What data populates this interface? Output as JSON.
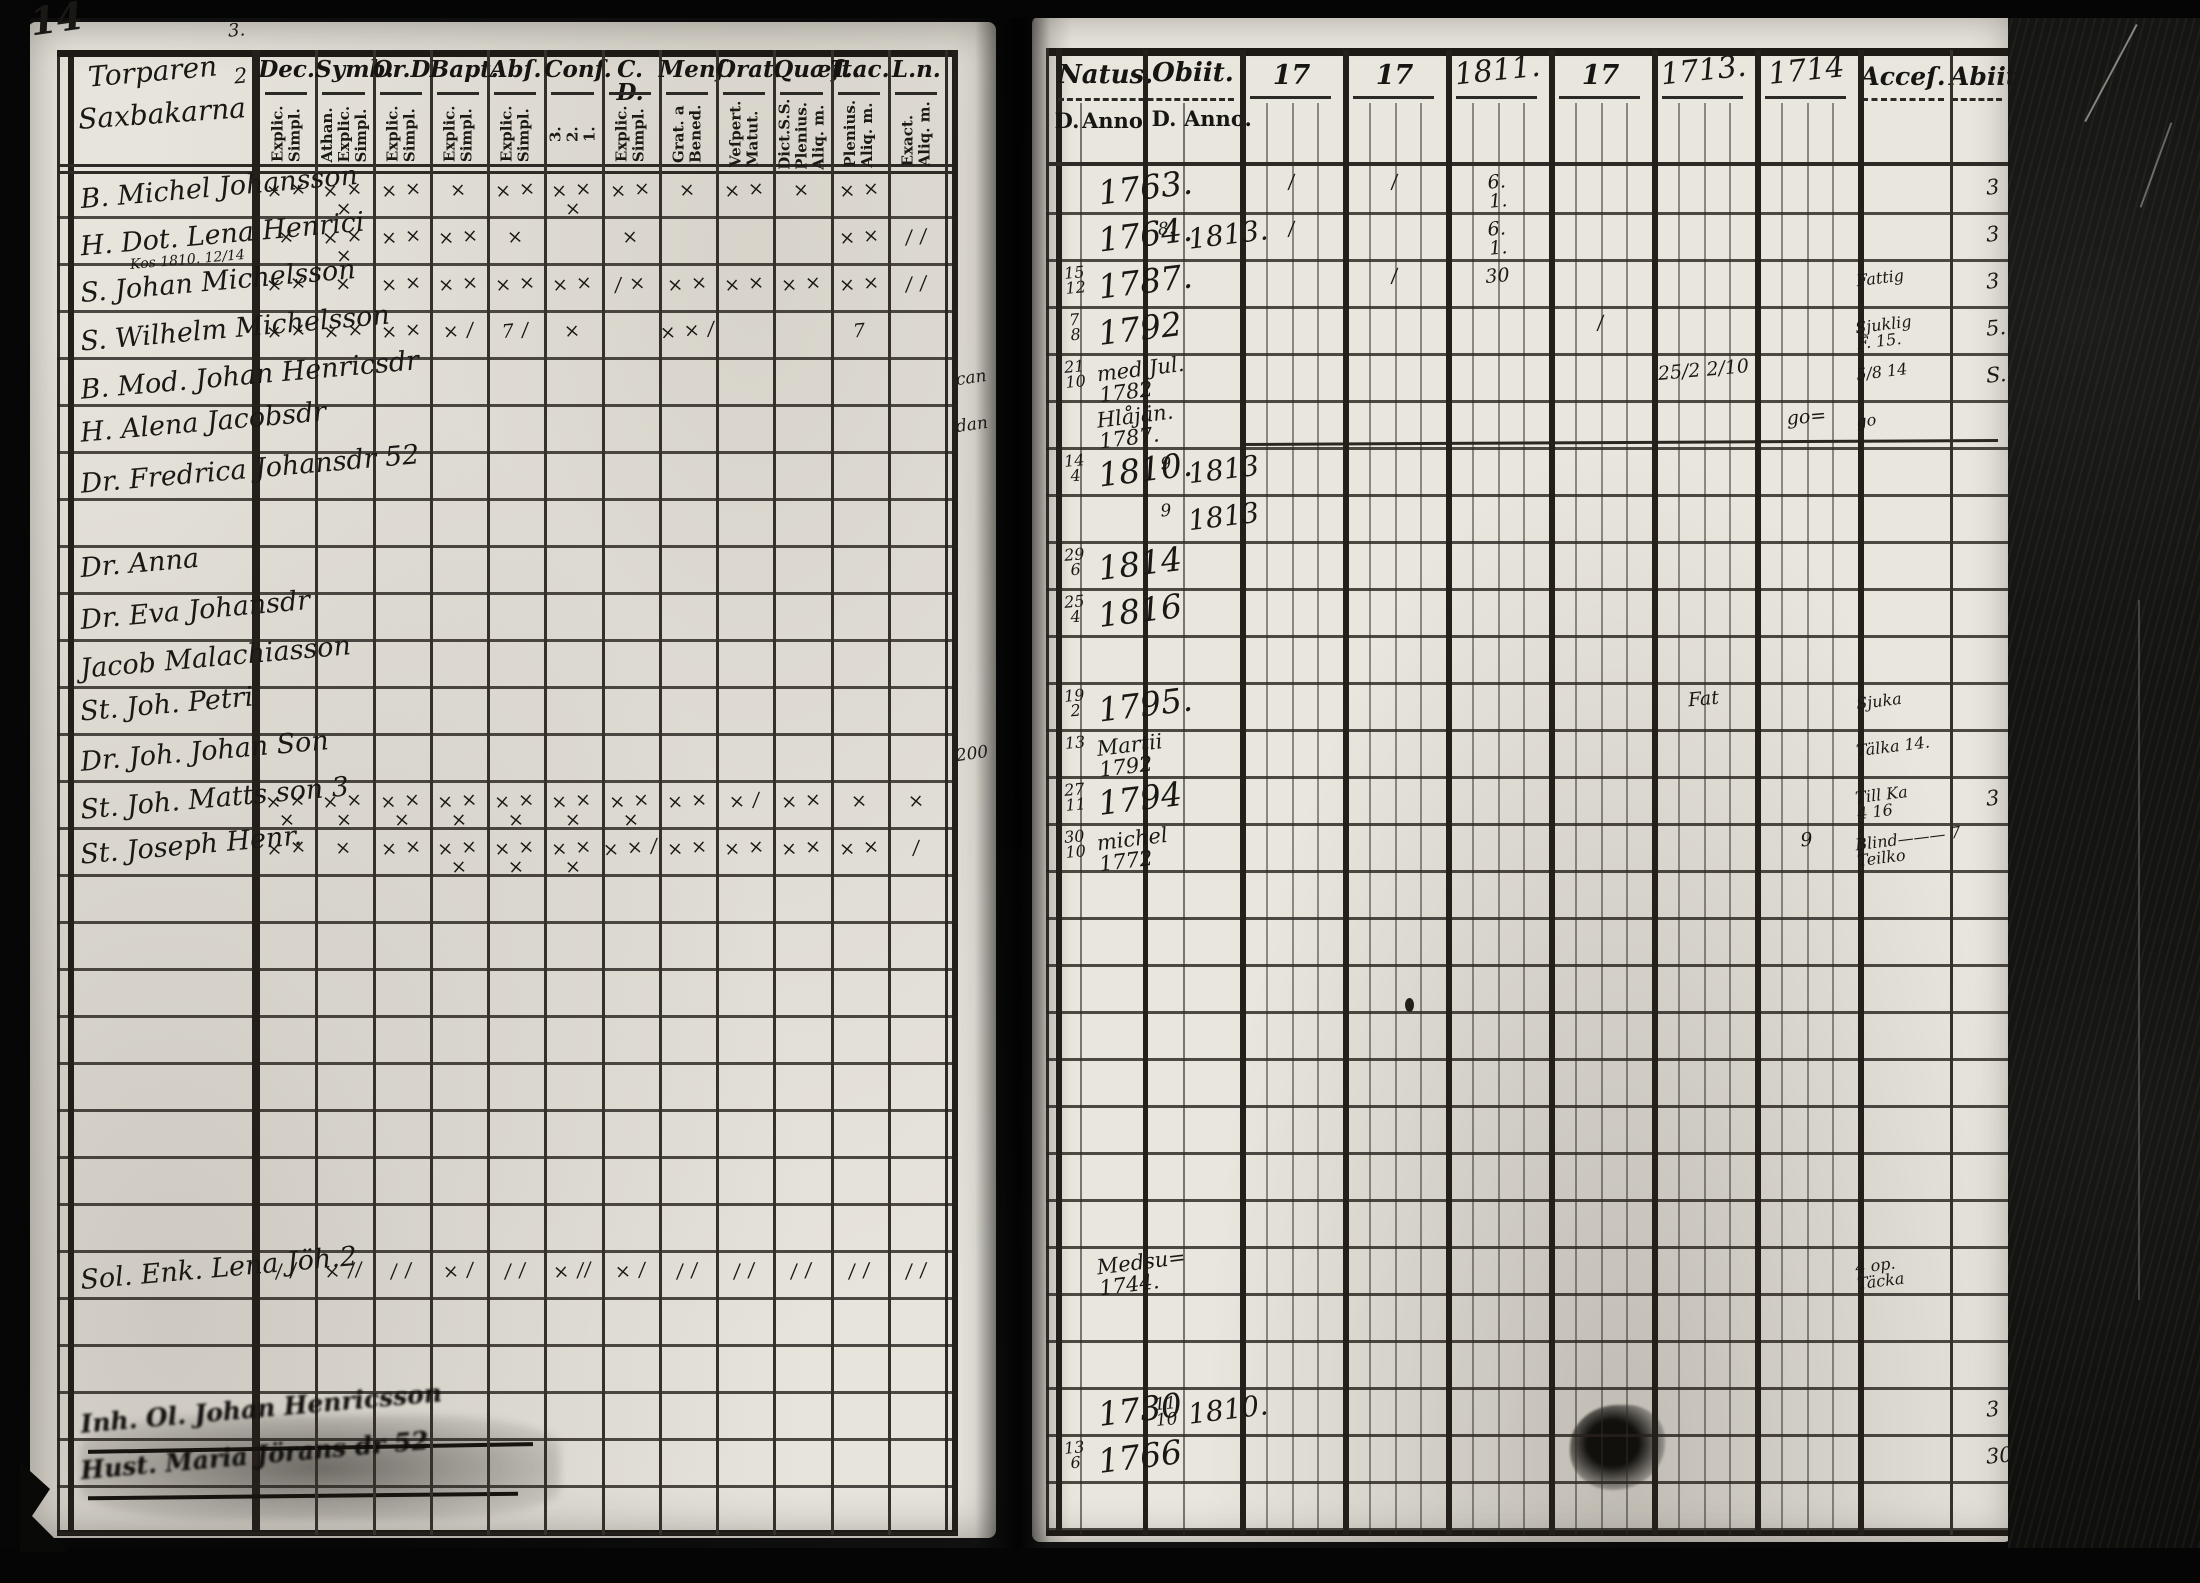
{
  "scan": {
    "page_number": "14"
  },
  "left_page": {
    "title_lines": [
      "Torparen",
      "Saxbakarna"
    ],
    "top_scribble": "3.",
    "side_scribble": "2",
    "columns": [
      {
        "label": "Dec.",
        "sub": [
          "Explic.",
          "Simpl."
        ]
      },
      {
        "label": "Symb.",
        "sub": [
          "Athan.",
          "Explic.",
          "Simpl."
        ]
      },
      {
        "label": "Or.D.",
        "sub": [
          "Explic.",
          "Simpl."
        ]
      },
      {
        "label": "Bapt.",
        "sub": [
          "Explic.",
          "Simpl."
        ]
      },
      {
        "label": "Abſ.",
        "sub": [
          "Explic.",
          "Simpl."
        ]
      },
      {
        "label": "Conf.",
        "sub": [
          "3.",
          "2.",
          "1."
        ]
      },
      {
        "label": "C. D.",
        "sub": [
          "Explic.",
          "Simpl."
        ]
      },
      {
        "label": "Menſ.",
        "sub": [
          "Grat. a",
          "Bened."
        ]
      },
      {
        "label": "Orat.",
        "sub": [
          "Veſpert.",
          "Matut."
        ]
      },
      {
        "label": "Quæſt.",
        "sub": [
          "Dict.S.S.",
          "Plenius.",
          "Aliq. m."
        ]
      },
      {
        "label": "T.ac.",
        "sub": [
          "Plenius.",
          "Aliq. m."
        ]
      },
      {
        "label": "L.n.",
        "sub": [
          "Exact.",
          "Aliq. m."
        ]
      }
    ],
    "entries": [
      {
        "row": 0,
        "name": "B. Michel Johansson",
        "marks": [
          "× ×",
          "× × ×",
          "× ×",
          "×",
          "× ×",
          "× × ×",
          "× ×",
          "×",
          "× ×",
          "×",
          "× ×",
          ""
        ]
      },
      {
        "row": 1,
        "name": "H. Dot. Lena Henrici",
        "marks": [
          "×",
          "× × ×",
          "× ×",
          "× ×",
          "×",
          "",
          "×",
          "",
          "",
          "",
          "× ×",
          "/ /"
        ]
      },
      {
        "row": 2,
        "name": "S. Johan Michelsson",
        "note": "Kos 1810. 12/14",
        "marks": [
          "× ×",
          "×",
          "× ×",
          "× ×",
          "× ×",
          "× ×",
          "/ ×",
          "× ×",
          "× ×",
          "× ×",
          "× ×",
          "/ /"
        ]
      },
      {
        "row": 3,
        "name": "S. Wilhelm Michelsson",
        "marks": [
          "× ×",
          "× ×",
          "× ×",
          "× /",
          "7 /",
          "×",
          "",
          "× × /",
          "",
          "",
          "7",
          ""
        ]
      },
      {
        "row": 4,
        "name": "B. Mod. Johan Henricsdr"
      },
      {
        "row": 5,
        "name": "H. Alena Jacobsdr"
      },
      {
        "row": 6,
        "name": "Dr. Fredrica Johansdr 52"
      },
      {
        "row": 8,
        "name": "Dr. Anna"
      },
      {
        "row": 9,
        "name": "Dr. Eva Johansdr"
      },
      {
        "row": 10,
        "name": "Jacob Malachiasson"
      },
      {
        "row": 11,
        "name": "St. Joh. Petri"
      },
      {
        "row": 12,
        "name": "Dr. Joh. Johan Son"
      },
      {
        "row": 13,
        "name": "St. Joh. Matts son 3",
        "marks": [
          "× × ×",
          "× × ×",
          "× × ×",
          "× × ×",
          "× × ×",
          "× × ×",
          "× × ×",
          "× ×",
          "× /",
          "× ×",
          "×",
          "×"
        ]
      },
      {
        "row": 14,
        "name": "St. Joseph Henr.",
        "marks": [
          "× ×",
          "×",
          "× ×",
          "× × ×",
          "× × ×",
          "× × ×",
          "× × /",
          "× ×",
          "× ×",
          "× ×",
          "× ×",
          "/"
        ]
      },
      {
        "row": 23,
        "name": "Sol. Enk. Lena Jöh.2",
        "marks": [
          "/ /",
          "× //",
          "/ /",
          "× /",
          "/ /",
          "× //",
          "× /",
          "/ /",
          "/ /",
          "/ /",
          "/ /",
          "/ /"
        ]
      },
      {
        "row": 26,
        "name": "Inh. Ol. Johan Henricsson",
        "smudged": true
      },
      {
        "row": 27,
        "name": "Hust. Maria Jörans dr 52",
        "smudged": true
      }
    ],
    "margin_notes": [
      {
        "row": 4,
        "text": "can"
      },
      {
        "row": 5,
        "text": "dan"
      },
      {
        "row": 12,
        "text": "200"
      }
    ]
  },
  "right_page": {
    "natus_label": "Natus.",
    "obiit_label": "Obiit.",
    "d_label": "D.",
    "anno_label": "Anno.",
    "year_columns": [
      {
        "t": "17",
        "hw": false
      },
      {
        "t": "17",
        "hw": false
      },
      {
        "t": "1811.",
        "hw": true
      },
      {
        "t": "17",
        "hw": false
      },
      {
        "t": "1713.",
        "hw": true
      },
      {
        "t": "1714",
        "hw": true
      }
    ],
    "acces_label": "Acceſ.",
    "abiit_label": "Abiit",
    "entries": [
      {
        "row": 0,
        "natus_anno": "1763.",
        "y1": "/",
        "y2": "/",
        "y3": "6.\n1.",
        "edge": "3"
      },
      {
        "row": 1,
        "natus_anno": "1764.",
        "obiit_d": "8.",
        "obiit_anno": "1813.",
        "y1": "/",
        "y3": "6.\n1.",
        "edge": "3"
      },
      {
        "row": 2,
        "natus_d": "15\n12",
        "natus_anno": "1787.",
        "y2": "/",
        "y3": "30",
        "acces": "Fattig",
        "edge": "3"
      },
      {
        "row": 3,
        "natus_d": "7\n8",
        "natus_anno": "1792",
        "y4": "/",
        "acces": "Sjuklig\nF. 15.",
        "edge": "5."
      },
      {
        "row": 4,
        "natus_d": "21\n10",
        "natus_anno": "med Jul.\n1782",
        "y5": "25/2   2/10",
        "acces": "5/8 14",
        "edge": "S."
      },
      {
        "row": 5,
        "natus_anno": "Hlåjän.\n1787.",
        "y6": "go=",
        "acces": "go"
      },
      {
        "row": 6,
        "natus_d": "14\n4",
        "natus_anno": "1810.",
        "obiit_d": "9",
        "obiit_anno": "1813"
      },
      {
        "row": 7,
        "obiit_d": "9",
        "obiit_anno": "1813"
      },
      {
        "row": 8,
        "natus_d": "29\n6",
        "natus_anno": "1814"
      },
      {
        "row": 9,
        "natus_d": "25\n4",
        "natus_anno": "1816"
      },
      {
        "row": 11,
        "natus_d": "19\n2",
        "natus_anno": "1795.",
        "y5": "Fat",
        "acces": "Sjuka"
      },
      {
        "row": 12,
        "natus_d": "13",
        "natus_anno": "Martii\n1792",
        "acces": "Tälka 14."
      },
      {
        "row": 13,
        "natus_d": "27\n11",
        "natus_anno": "1794",
        "acces": "Till Ka\n4 16",
        "edge": "3"
      },
      {
        "row": 14,
        "natus_d": "30\n10",
        "natus_anno": "michel\n1772",
        "y6": "9",
        "acces": "Blind——— 7\nTeilko"
      },
      {
        "row": 23,
        "natus_anno": "Medsu=\n1744.",
        "acces": "4 op.\nTäcka"
      },
      {
        "row": 26,
        "natus_anno": "1730",
        "obiit_d": "11\n10",
        "obiit_anno": "1810.",
        "edge": "3"
      },
      {
        "row": 27,
        "natus_d": "13\n6",
        "natus_anno": "1766",
        "edge": "30."
      }
    ]
  }
}
